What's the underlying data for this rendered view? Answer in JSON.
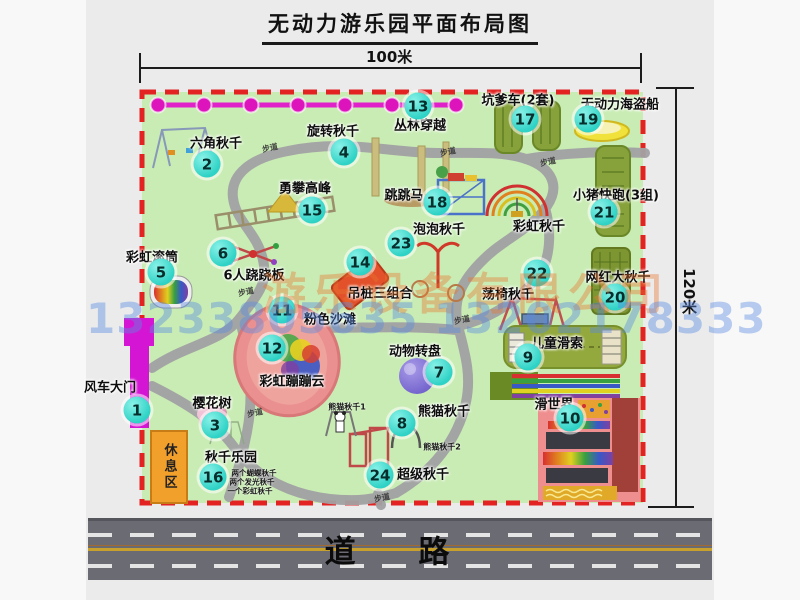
{
  "title": "无动力游乐园平面布局图",
  "dims": {
    "width": "100米",
    "height": "120米"
  },
  "road": {
    "label": "道 路"
  },
  "rest_area": {
    "label": "休息区"
  },
  "watermark": {
    "company": "游乐设备有限公司",
    "phone": "13233805635 13202178333"
  },
  "path_labels": {
    "text": "步道",
    "positions": [
      [
        270,
        148
      ],
      [
        448,
        152
      ],
      [
        548,
        162
      ],
      [
        246,
        292
      ],
      [
        462,
        320
      ],
      [
        255,
        413
      ],
      [
        382,
        498
      ]
    ]
  },
  "facilities": [
    {
      "num": 1,
      "name": "风车大门",
      "bx": 137,
      "by": 410,
      "lx": 110,
      "ly": 386
    },
    {
      "num": 2,
      "name": "六角秋千",
      "bx": 207,
      "by": 164,
      "lx": 216,
      "ly": 142
    },
    {
      "num": 3,
      "name": "樱花树",
      "bx": 215,
      "by": 425,
      "lx": 212,
      "ly": 402
    },
    {
      "num": 4,
      "name": "旋转秋千",
      "bx": 344,
      "by": 152,
      "lx": 333,
      "ly": 130
    },
    {
      "num": 5,
      "name": "彩虹滚筒",
      "bx": 161,
      "by": 272,
      "lx": 152,
      "ly": 256
    },
    {
      "num": 6,
      "name": "6人跷跷板",
      "bx": 223,
      "by": 253,
      "lx": 254,
      "ly": 274
    },
    {
      "num": 7,
      "name": "动物转盘",
      "bx": 439,
      "by": 372,
      "lx": 415,
      "ly": 350
    },
    {
      "num": 8,
      "name": "熊猫秋千",
      "bx": 402,
      "by": 423,
      "lx": 444,
      "ly": 410
    },
    {
      "num": 9,
      "name": "儿童滑索",
      "bx": 528,
      "by": 357,
      "lx": 557,
      "ly": 342
    },
    {
      "num": 10,
      "name": "滑世界",
      "bx": 570,
      "by": 418,
      "lx": 554,
      "ly": 403
    },
    {
      "num": 11,
      "name": "粉色沙滩",
      "bx": 282,
      "by": 310,
      "lx": 330,
      "ly": 318
    },
    {
      "num": 12,
      "name": "彩虹蹦蹦云",
      "bx": 272,
      "by": 348,
      "lx": 292,
      "ly": 380
    },
    {
      "num": 13,
      "name": "丛林穿越",
      "bx": 418,
      "by": 106,
      "lx": 420,
      "ly": 124
    },
    {
      "num": 14,
      "name": "吊桩三组合",
      "bx": 360,
      "by": 262,
      "lx": 380,
      "ly": 292
    },
    {
      "num": 15,
      "name": "勇攀高峰",
      "bx": 312,
      "by": 210,
      "lx": 305,
      "ly": 187
    },
    {
      "num": 16,
      "name": "秋千乐园",
      "bx": 213,
      "by": 477,
      "lx": 231,
      "ly": 456
    },
    {
      "num": 17,
      "name": "坑爹车(2套)",
      "bx": 525,
      "by": 119,
      "lx": 518,
      "ly": 99
    },
    {
      "num": 18,
      "name": "跳跳马",
      "bx": 437,
      "by": 202,
      "lx": 404,
      "ly": 194
    },
    {
      "num": 19,
      "name": "无动力海盗船",
      "bx": 588,
      "by": 119,
      "lx": 620,
      "ly": 103
    },
    {
      "num": 20,
      "name": "网红大秋千",
      "bx": 615,
      "by": 297,
      "lx": 618,
      "ly": 276
    },
    {
      "num": 21,
      "name": "小猪快跑(3组)",
      "bx": 604,
      "by": 212,
      "lx": 616,
      "ly": 194
    },
    {
      "num": 22,
      "name": "荡椅秋千",
      "bx": 537,
      "by": 273,
      "lx": 508,
      "ly": 293
    },
    {
      "num": 23,
      "name": "泡泡秋千",
      "bx": 401,
      "by": 243,
      "lx": 439,
      "ly": 228
    },
    {
      "num": 24,
      "name": "超级秋千",
      "bx": 380,
      "by": 475,
      "lx": 423,
      "ly": 473
    },
    {
      "name": "彩虹秋千",
      "lx": 539,
      "ly": 225
    }
  ],
  "sub_labels": [
    {
      "text": "熊猫秋千1",
      "x": 347,
      "y": 407,
      "fs": 8
    },
    {
      "text": "熊猫秋千2",
      "x": 442,
      "y": 447,
      "fs": 8
    },
    {
      "text": "两个蝴蝶秋千",
      "x": 254,
      "y": 473,
      "fs": 7.5
    },
    {
      "text": "两个发光秋千",
      "x": 252,
      "y": 482,
      "fs": 7.5
    },
    {
      "text": "一个彩虹秋千",
      "x": 250,
      "y": 491,
      "fs": 7.5
    }
  ]
}
